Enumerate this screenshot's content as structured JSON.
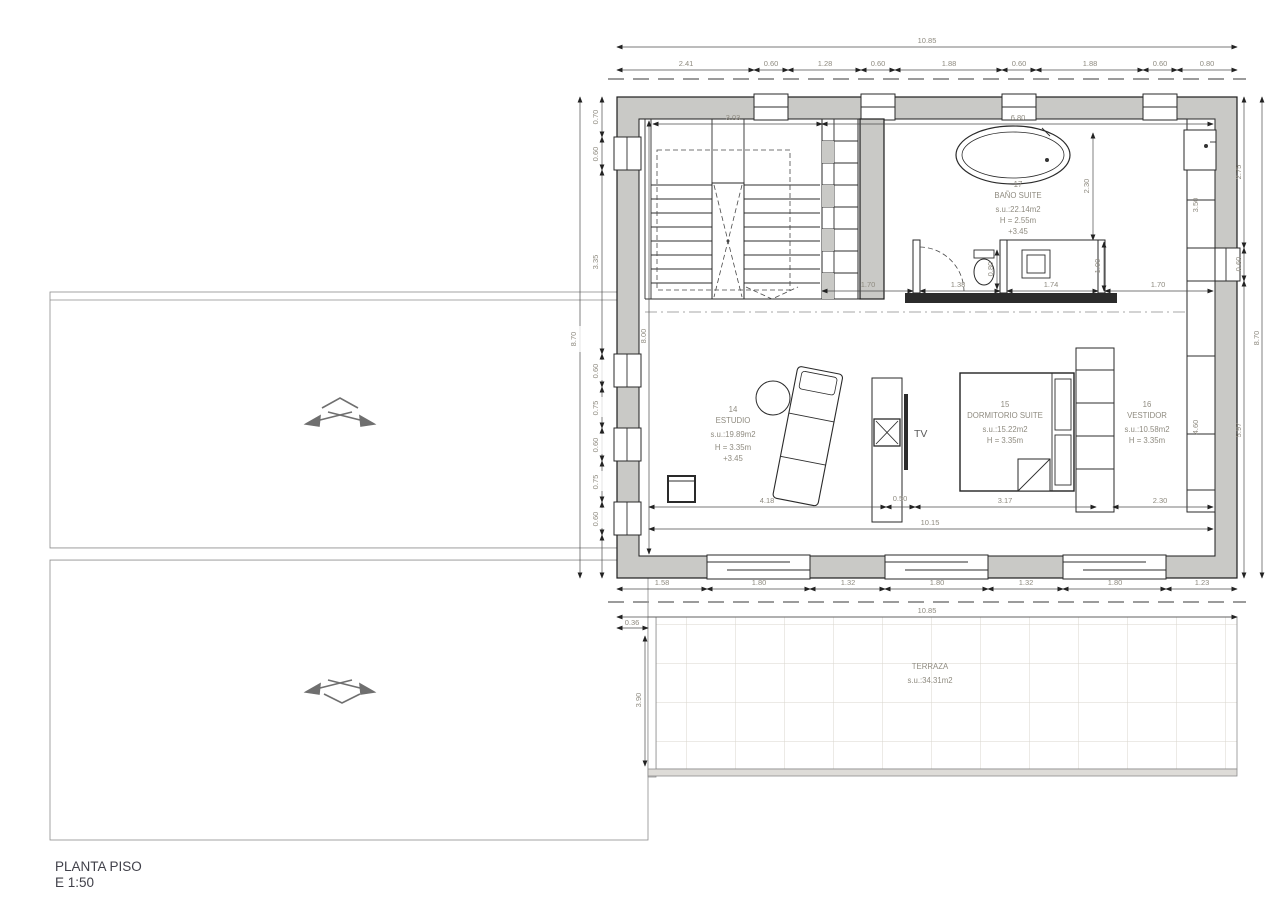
{
  "title": {
    "name": "PLANTA PISO",
    "scale": "E 1:50"
  },
  "rooms": {
    "bano": {
      "number": "17",
      "name": "BAÑO SUITE",
      "area": "s.u.:22.14m2",
      "height": "H = 2.55m",
      "level": "+3.45"
    },
    "estudio": {
      "number": "14",
      "name": "ESTUDIO",
      "area": "s.u.:19.89m2",
      "height": "H = 3.35m",
      "level": "+3.45"
    },
    "dormitorio": {
      "number": "15",
      "name": "DORMITORIO SUITE",
      "area": "s.u.:15.22m2",
      "height": "H = 3.35m"
    },
    "vestidor": {
      "number": "16",
      "name": "VESTIDOR",
      "area": "s.u.:10.58m2",
      "height": "H = 3.35m"
    },
    "terraza": {
      "name": "TERRAZA",
      "area": "s.u.:34.31m2"
    }
  },
  "furniture": {
    "tv_label": "TV"
  },
  "dims": {
    "top_total": "10.85",
    "top": [
      "2.41",
      "0.60",
      "1.28",
      "0.60",
      "1.88",
      "0.60",
      "1.88",
      "0.60",
      "0.80"
    ],
    "bottom": [
      "1.58",
      "1.80",
      "1.32",
      "1.80",
      "1.32",
      "1.80",
      "1.23"
    ],
    "bottom_total": "10.85",
    "left": [
      "0.70",
      "0.60",
      "3.35",
      "0.60",
      "0.75",
      "0.60",
      "0.75",
      "0.60"
    ],
    "left_total": "8.70",
    "right": [
      "2.75",
      "0.60",
      "5.97"
    ],
    "right_total": "8.70",
    "interior_height": "8.00",
    "stairs_width": "3.03",
    "bath_width": "6.80",
    "bath_depth": "2.30",
    "partition": [
      "1.70",
      "1.38",
      "0.80",
      "1.74",
      "1.00",
      "1.70"
    ],
    "closet_upper": "3.50",
    "closet_lower": "4.60",
    "interior_bottom": [
      "4.18",
      "0.50",
      "3.17",
      "2.30"
    ],
    "interior_bottom_total": "10.15",
    "terrace_offset": "0.36",
    "terrace_depth": "3.90"
  },
  "colors": {
    "wall_fill": "#c9c9c6",
    "line": "#2a2a2a",
    "dim_text": "#8f8b80"
  }
}
